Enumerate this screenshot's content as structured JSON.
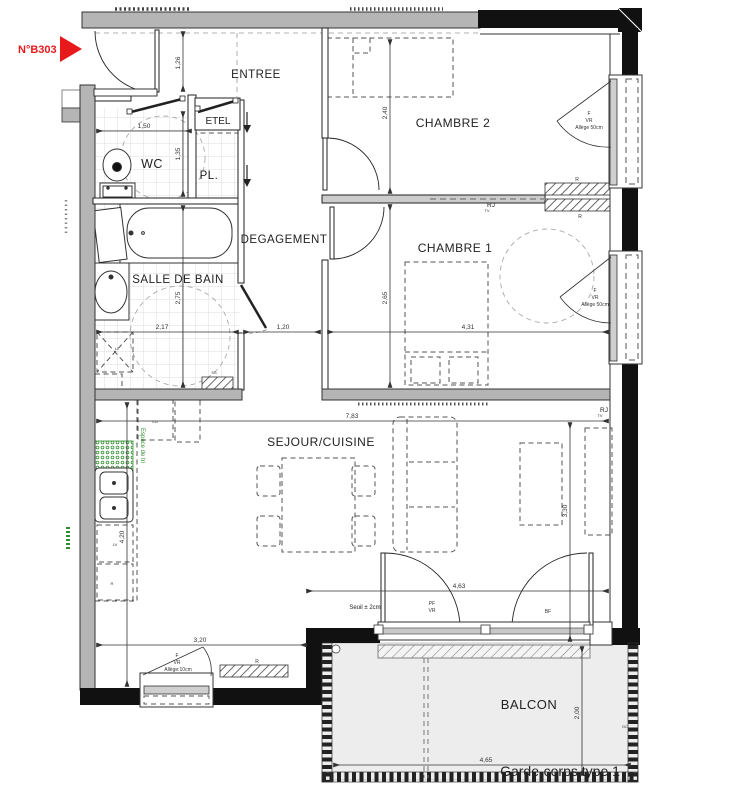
{
  "unit_label": "N°B303",
  "rooms": {
    "entree": "ENTREE",
    "wc": "WC",
    "pl": "PL.",
    "etel": "ETEL",
    "chambre2": "CHAMBRE 2",
    "chambre1": "CHAMBRE 1",
    "degagement": "DEGAGEMENT",
    "salle_de_bain": "SALLE DE BAIN",
    "sejour_cuisine": "SEJOUR/CUISINE",
    "balcon": "BALCON"
  },
  "dimensions": {
    "entry_depth": "1,26",
    "wc_width": "1,50",
    "wc_depth": "1,35",
    "chambre2_depth": "2,40",
    "sdb_depth": "2,75",
    "sdb_width": "2,17",
    "degagement_width": "1,20",
    "chambre1_width": "4,31",
    "chambre1_depth": "2,65",
    "sejour_width": "7,83",
    "cuisine_depth": "4,20",
    "sejour_depth": "3,30",
    "baie_width": "4,63",
    "fenetre_width": "3,20",
    "balcon_width": "4,65",
    "balcon_depth": "2,00"
  },
  "openings": {
    "window_c2": {
      "l1": "F",
      "l2": "VR",
      "l3": "Allège 50cm"
    },
    "window_c1": {
      "l1": "F",
      "l2": "VR",
      "l3": "Allège 50cm"
    },
    "window_sejour": {
      "l1": "F",
      "l2": "VR",
      "l3": "Allège:10cm"
    },
    "bay": {
      "l1": "PF",
      "l2": "VR"
    },
    "seuil": "Seuil ± 2cm",
    "garde_corps": "Garde-corps type 1"
  },
  "equipment": {
    "ll": "LL",
    "lv": "LV",
    "fridge": "R",
    "cu": "CU",
    "ss": "SS",
    "bf": "BF",
    "gc": "GC",
    "rj1": "RJ",
    "rj1_sub": "TV",
    "rj2": "RJ",
    "rj2_sub": "TV",
    "r_wall_top": "R",
    "r_wall_bottom": "R",
    "r_wall_sejour": "R",
    "espace_tri": "Espace de tri"
  },
  "colors": {
    "accent_red": "#e8191c",
    "eco_green": "#2f8f2f",
    "wall_gray": "#b5b5b5",
    "wall_black": "#111111",
    "balcony_floor": "#ededed"
  }
}
